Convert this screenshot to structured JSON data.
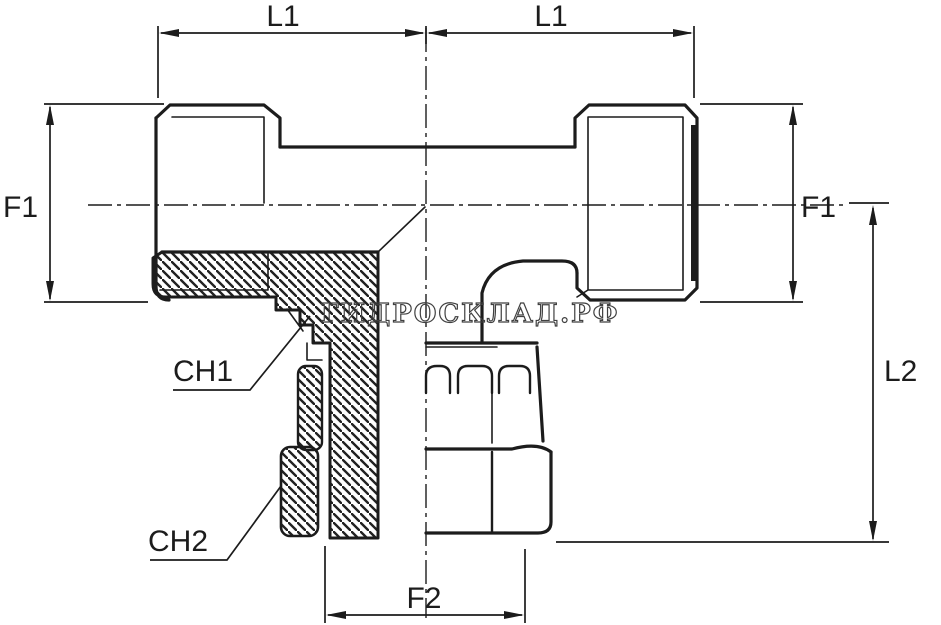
{
  "watermark": {
    "text": "ГИДРОСКЛАД.РФ"
  },
  "dimensions": {
    "l1_left": "L1",
    "l1_right": "L1",
    "f1_left": "F1",
    "f1_right": "F1",
    "l2": "L2",
    "f2": "F2"
  },
  "callouts": {
    "ch1": "CH1",
    "ch2": "CH2"
  },
  "colors": {
    "line": "#1c1c1c",
    "background": "#ffffff",
    "watermark_outline": "#404040"
  }
}
